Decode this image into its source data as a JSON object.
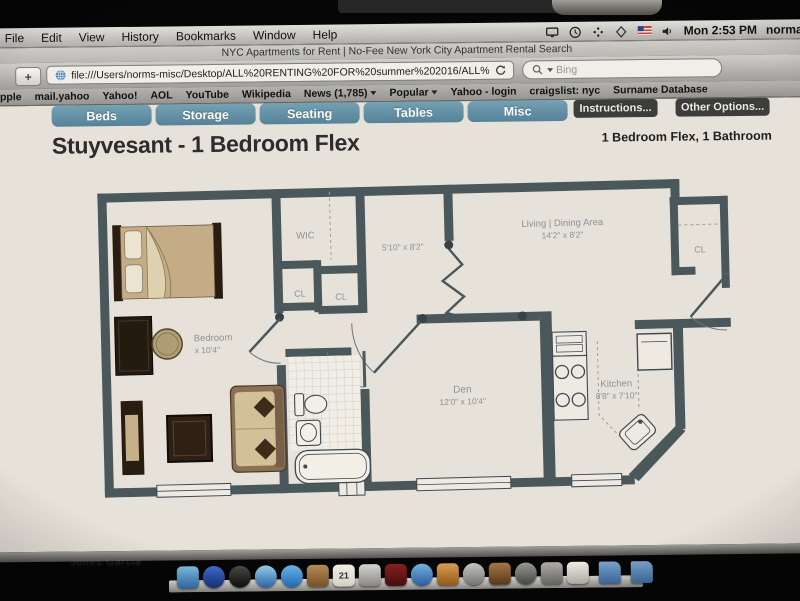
{
  "menu_bar": {
    "items": [
      "File",
      "Edit",
      "View",
      "History",
      "Bookmarks",
      "Window",
      "Help"
    ],
    "status": {
      "time": "Mon 2:53 PM",
      "user": "norma"
    }
  },
  "window": {
    "title": "NYC Apartments for Rent | No-Fee New York City Apartment Rental Search"
  },
  "toolbar": {
    "new_tab_label": "+",
    "url": "file:///Users/norms-misc/Desktop/ALL%20RENTING%20FOR%20summer%202016/ALL%20PHOTOS%20OFAPT%202016/NYC%20Ap",
    "search_placeholder": "Bing"
  },
  "bookmarks_bar": {
    "items": [
      "Apple",
      "mail.yahoo",
      "Yahoo!",
      "AOL",
      "YouTube",
      "Wikipedia",
      "News (1,785)",
      "Popular",
      "Yahoo - login",
      "craigslist: nyc",
      "Surname Database"
    ]
  },
  "page": {
    "category_buttons": [
      {
        "label": "Beds",
        "style": "blue"
      },
      {
        "label": "Storage",
        "style": "blue"
      },
      {
        "label": "Seating",
        "style": "blue"
      },
      {
        "label": "Tables",
        "style": "blue"
      },
      {
        "label": "Misc",
        "style": "blue"
      },
      {
        "label": "Instructions...",
        "style": "dark"
      },
      {
        "label": "Other Options...",
        "style": "dark"
      }
    ],
    "heading": "Stuyvesant - 1 Bedroom Flex",
    "subheading": "1 Bedroom Flex, 1 Bathroom",
    "floor_plan": {
      "labels": {
        "wic": "WIC",
        "cl": "CL",
        "hall_dims": "5'10\" x 8'2\"",
        "living_name": "Living | Dining Area",
        "living_dims": "14'2\" x 8'2\"",
        "den_name": "Den",
        "den_dims": "12'0\" x 10'4\"",
        "kitchen_name": "Kitchen",
        "kitchen_dims": "8'8\" x 7'10\"",
        "bedroom_name": "Bedroom",
        "bedroom_dims": "x 10'4\""
      }
    }
  },
  "desktop": {
    "faint_label": "Jones Garcia"
  },
  "dock": {
    "icons": [
      {
        "name": "finder-icon",
        "c1": "#7ec0e8",
        "c2": "#2f6fb2"
      },
      {
        "name": "app-store-icon",
        "c1": "#3a6fd8",
        "c2": "#16337e",
        "round": true
      },
      {
        "name": "dashboard-icon",
        "c1": "#4a4a4a",
        "c2": "#101010",
        "round": true
      },
      {
        "name": "safari-icon",
        "c1": "#8fd0f0",
        "c2": "#2b6cb8",
        "round": true
      },
      {
        "name": "ichat-icon",
        "c1": "#66b6f0",
        "c2": "#1f6fc0",
        "round": true
      },
      {
        "name": "address-book-icon",
        "c1": "#b98d5a",
        "c2": "#7a5526"
      },
      {
        "name": "ical-icon",
        "c1": "#f4f2ec",
        "c2": "#d8d5cc",
        "label": "21"
      },
      {
        "name": "photos-icon",
        "c1": "#d8d8d4",
        "c2": "#8a8a86"
      },
      {
        "name": "front-row-icon",
        "c1": "#8c1f1f",
        "c2": "#4a0d0d"
      },
      {
        "name": "itunes-icon",
        "c1": "#6fb6e8",
        "c2": "#2a5fae",
        "round": true
      },
      {
        "name": "photo-booth-icon",
        "c1": "#e0a050",
        "c2": "#9a5a18"
      },
      {
        "name": "quicktime-icon",
        "c1": "#c8c8c4",
        "c2": "#787874",
        "round": true
      },
      {
        "name": "garageband-icon",
        "c1": "#a87848",
        "c2": "#5c3a18"
      },
      {
        "name": "camera-icon",
        "c1": "#9a9a98",
        "c2": "#4a4a48",
        "round": true
      },
      {
        "name": "system-preferences-icon",
        "c1": "#b0b0ae",
        "c2": "#6a6a68"
      },
      {
        "name": "textedit-icon",
        "c1": "#f2f0ea",
        "c2": "#b8b6ae"
      },
      {
        "name": "documents-folder-icon",
        "c1": "#7aa8d8",
        "c2": "#3c6ea8",
        "folder": true
      },
      {
        "name": "downloads-folder-icon",
        "c1": "#7aa8d8",
        "c2": "#3c6ea8",
        "folder": true
      }
    ]
  },
  "colors": {
    "accent_blue": "#5d90aa",
    "button_dark": "#3e3e3e",
    "plan_wall": "#4a5a60",
    "plan_label": "#8d949b"
  }
}
